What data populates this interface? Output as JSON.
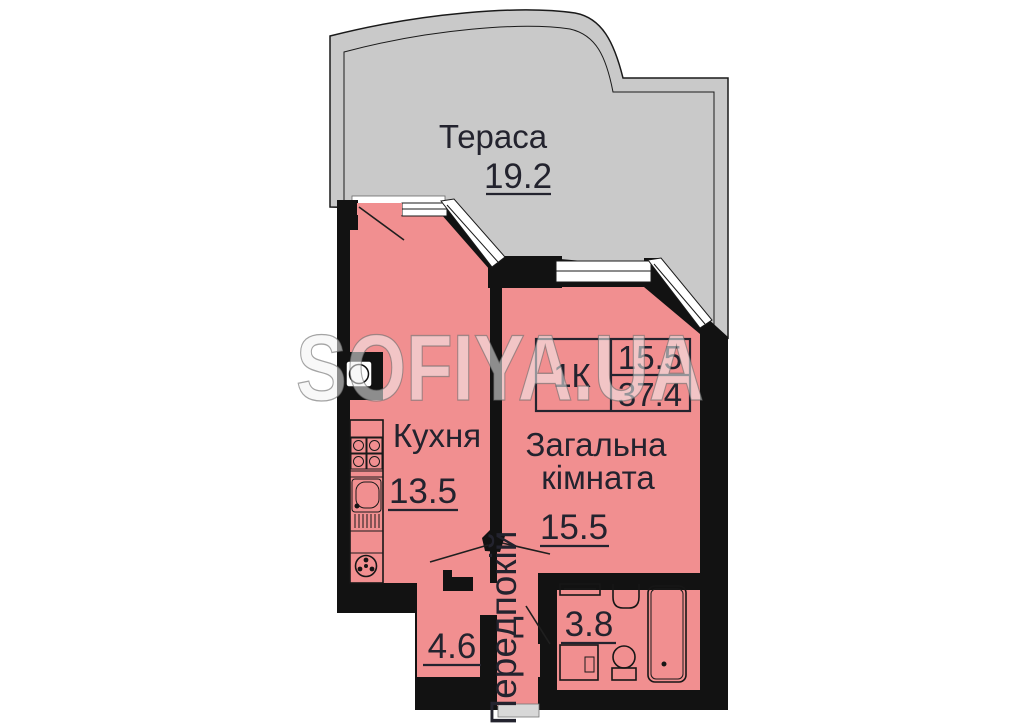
{
  "watermark": "SOFIYA.UA",
  "colors": {
    "room_fill": "#f18f90",
    "terrace_fill": "#c9c9c9",
    "wall": "#121212",
    "entrance_strip": "#d8d8d8"
  },
  "rooms": {
    "terrace": {
      "name": "Тераса",
      "area": "19.2"
    },
    "kitchen": {
      "name": "Кухня",
      "area": "13.5"
    },
    "living": {
      "name_line1": "Загальна",
      "name_line2": "кімната",
      "area": "15.5"
    },
    "hallway": {
      "name": "Передпокій",
      "area": "4.6"
    },
    "bathroom": {
      "area": "3.8"
    }
  },
  "info_box": {
    "apartment_type": "1К",
    "living_area": "15.5",
    "total_area": "37.4"
  }
}
